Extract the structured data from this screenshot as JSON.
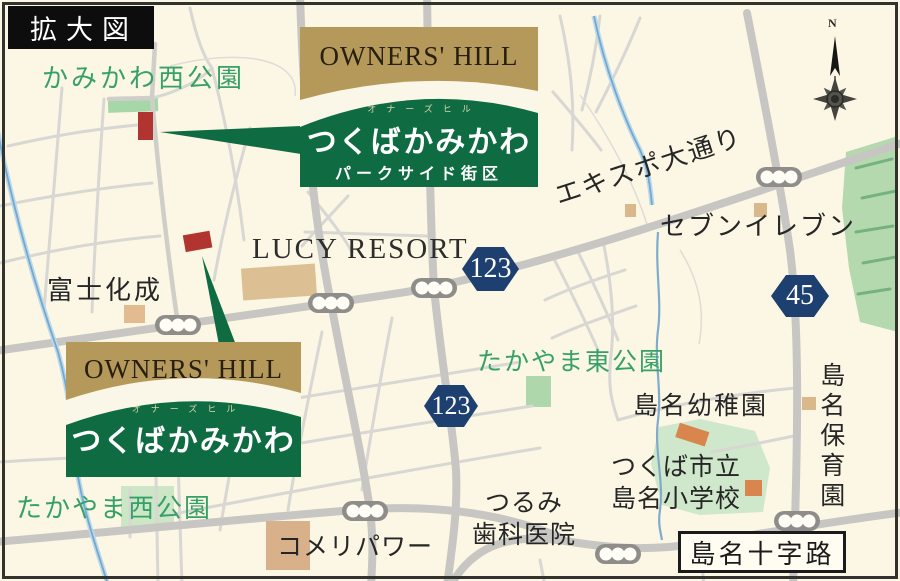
{
  "map": {
    "title": "拡大図",
    "compass_label": "N"
  },
  "badges": {
    "parkside": {
      "brand": "OWNERS' HILL",
      "furigana": "オナーズヒル",
      "name": "つくばかみかわ",
      "district": "パークサイド街区"
    },
    "main": {
      "brand": "OWNERS' HILL",
      "furigana": "オナーズヒル",
      "name": "つくばかみかわ"
    }
  },
  "route_signs": {
    "r123_north": "123",
    "r123_south": "123",
    "r45": "45"
  },
  "labels": {
    "kamikawa_west_park": "かみかわ西公園",
    "lucy_resort": "LUCY RESORT",
    "expo_avenue": "エキスポ大通り",
    "seven_eleven": "セブンイレブン",
    "fuji_kasei": "富士化成",
    "takayama_east_park": "たかやま東公園",
    "shimana_kindergarten": "島名幼稚園",
    "school_line1": "つくば市立",
    "school_line2": "島名小学校",
    "dental_line1": "つるみ",
    "dental_line2": "歯科医院",
    "komeri_power": "コメリパワー",
    "takayama_west_park": "たかやま西公園",
    "shimana_nursery": "島名保育園",
    "shimana_crossroad": "島名十字路"
  },
  "colors": {
    "map_background": "#fbf7e4",
    "brand_gold": "#b5995a",
    "brand_green": "#0e6b42",
    "route_navy": "#1e4070",
    "park_text_green": "#36a167",
    "plot_red": "#b23430"
  }
}
